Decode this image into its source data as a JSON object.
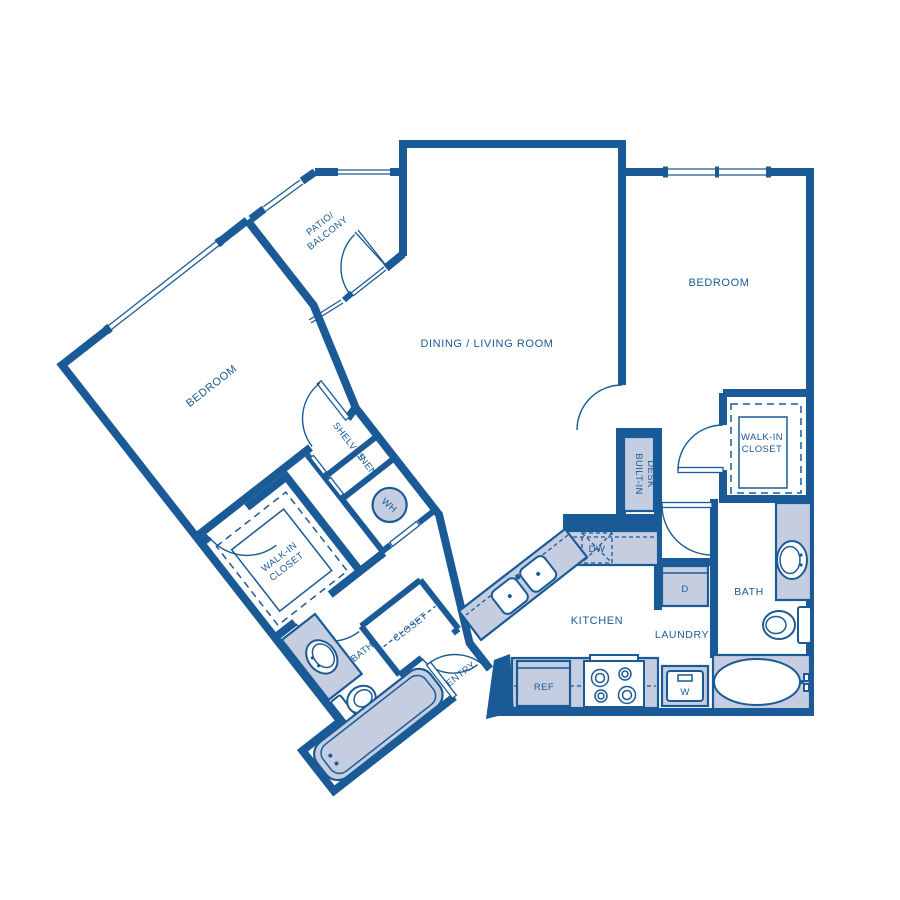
{
  "colors": {
    "wall_blue": "#1a5a96",
    "fixture_fill": "#c5cde1",
    "background": "#ffffff"
  },
  "rooms": {
    "dining_living": "DINING / LIVING ROOM",
    "patio_line1": "PATIO/",
    "patio_line2": "BALCONY",
    "bedroom_left": "BEDROOM",
    "bedroom_right": "BEDROOM",
    "walk_in_left_line1": "WALK-IN",
    "walk_in_left_line2": "CLOSET",
    "walk_in_right_line1": "WALK-IN",
    "walk_in_right_line2": "CLOSET",
    "bath_left": "BATH",
    "bath_right": "BATH",
    "closet": "CLOSET",
    "entry": "ENTRY",
    "kitchen": "KITCHEN",
    "laundry": "LAUNDRY"
  },
  "fixtures": {
    "shelves": "SHELVES",
    "linen": "LINEN",
    "water_heater": "WH",
    "built_in_desk_line1": "BUILT-IN",
    "built_in_desk_line2": "DESK",
    "dishwasher": "DW",
    "refrigerator": "REF",
    "dryer": "D",
    "washer": "W"
  }
}
